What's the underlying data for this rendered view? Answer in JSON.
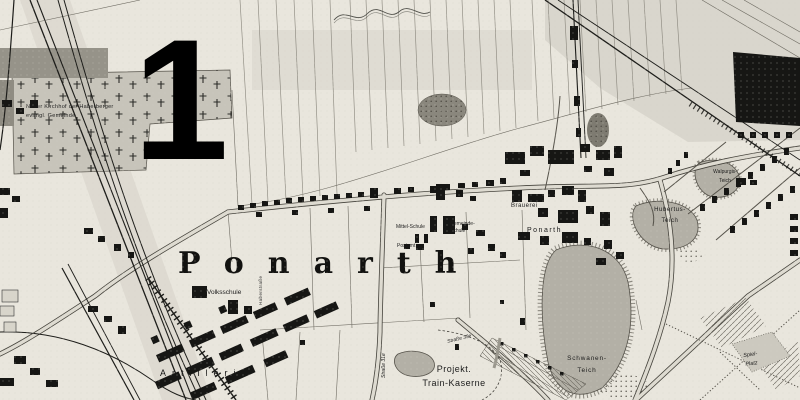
{
  "annotation": {
    "number": "1"
  },
  "colors": {
    "paper": "#e9e6dd",
    "water": "#b3b0a6",
    "ink": "#1a1a1a",
    "road_fill": "#dedbd1"
  },
  "map": {
    "title": "Ponarth",
    "labels": {
      "cemetery_line1": "Neuer Kirchhof der Haberberger",
      "cemetery_line2": "evangl. Gemeinde",
      "volksschule": "Volksschule",
      "mittel_schule": "Mittel-Schule",
      "postamt": "Postamt",
      "gemeinde_schule_line1": "Gemeinde-",
      "gemeinde_schule_line2": "Schule",
      "brauerei": "Brauerei",
      "brauerei_place": "Ponarth",
      "schwanen_line1": "Schwanen-",
      "schwanen_line2": "Teich",
      "hubertus_line1": "Hubertus-",
      "hubertus_line2": "Teich",
      "walpurgis_line1": "Walpurgis-",
      "walpurgis_line2": "Teich",
      "spielplatz_line1": "Spiel-",
      "spielplatz_line2": "Platz",
      "projekt_line1": "Projekt.",
      "projekt_line2": "Train-Kaserne",
      "artillerie": "Artillerie",
      "strasse_31e": "Straße 31e",
      "strasse_33e": "Straße 33e",
      "street_vertical": "Haberstraße"
    }
  }
}
